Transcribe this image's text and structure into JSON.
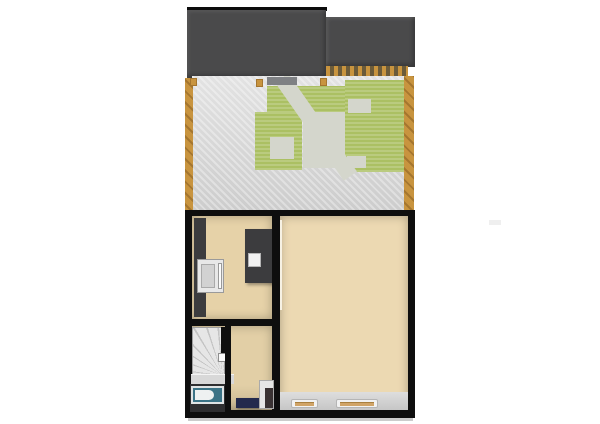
{
  "scene": {
    "type": "3d-floorplan-render",
    "view": "top-down",
    "text_content": "none"
  },
  "colors": {
    "page_bg": "#ffffff",
    "ridge": "#0c0c0c",
    "roof": "#4a4a4b",
    "pergola_dark": "#6b5b3a",
    "fence": "#c8943f",
    "fence_dark": "#a5762f",
    "gravel": "#d9d9d9",
    "grass": "#abc063",
    "path": "#d4d6cc",
    "garden_mat": "#7f8184",
    "wall": "#0e0e0e",
    "floor_kitchen": "#e6d2a8",
    "floor_hall": "#e2cfa6",
    "floor_main": "#ecd9b2",
    "furniture_dark": "#3c3c3e",
    "appliance": "#e8e8e8",
    "stairs_light": "#e6e6e6",
    "stairs_dark": "#c3c3c3",
    "tub": "#3b7386",
    "bath_floor": "#2e2e30",
    "sideboard": "#232a4d",
    "sill_wood": "#d0a468",
    "shadow": "#cccccc"
  },
  "garden": {
    "elements": [
      "roof-left",
      "roof-right",
      "ridge-line",
      "pergola-edge",
      "gravel-paving",
      "grass-band",
      "grass-right-block",
      "grass-left-l",
      "diagonal-path",
      "left-fence",
      "right-fence",
      "fence-posts",
      "doormat"
    ]
  },
  "house": {
    "rooms": [
      "kitchen",
      "stair-hall",
      "bathroom",
      "main-room"
    ],
    "objects": [
      "kitchen-tall-cabinet-wall",
      "oven",
      "kitchen-island",
      "island-sink",
      "winder-staircase",
      "newel-post",
      "bathtub",
      "navy-sideboard",
      "hall-cabinet",
      "window-sill",
      "window-sill"
    ]
  }
}
